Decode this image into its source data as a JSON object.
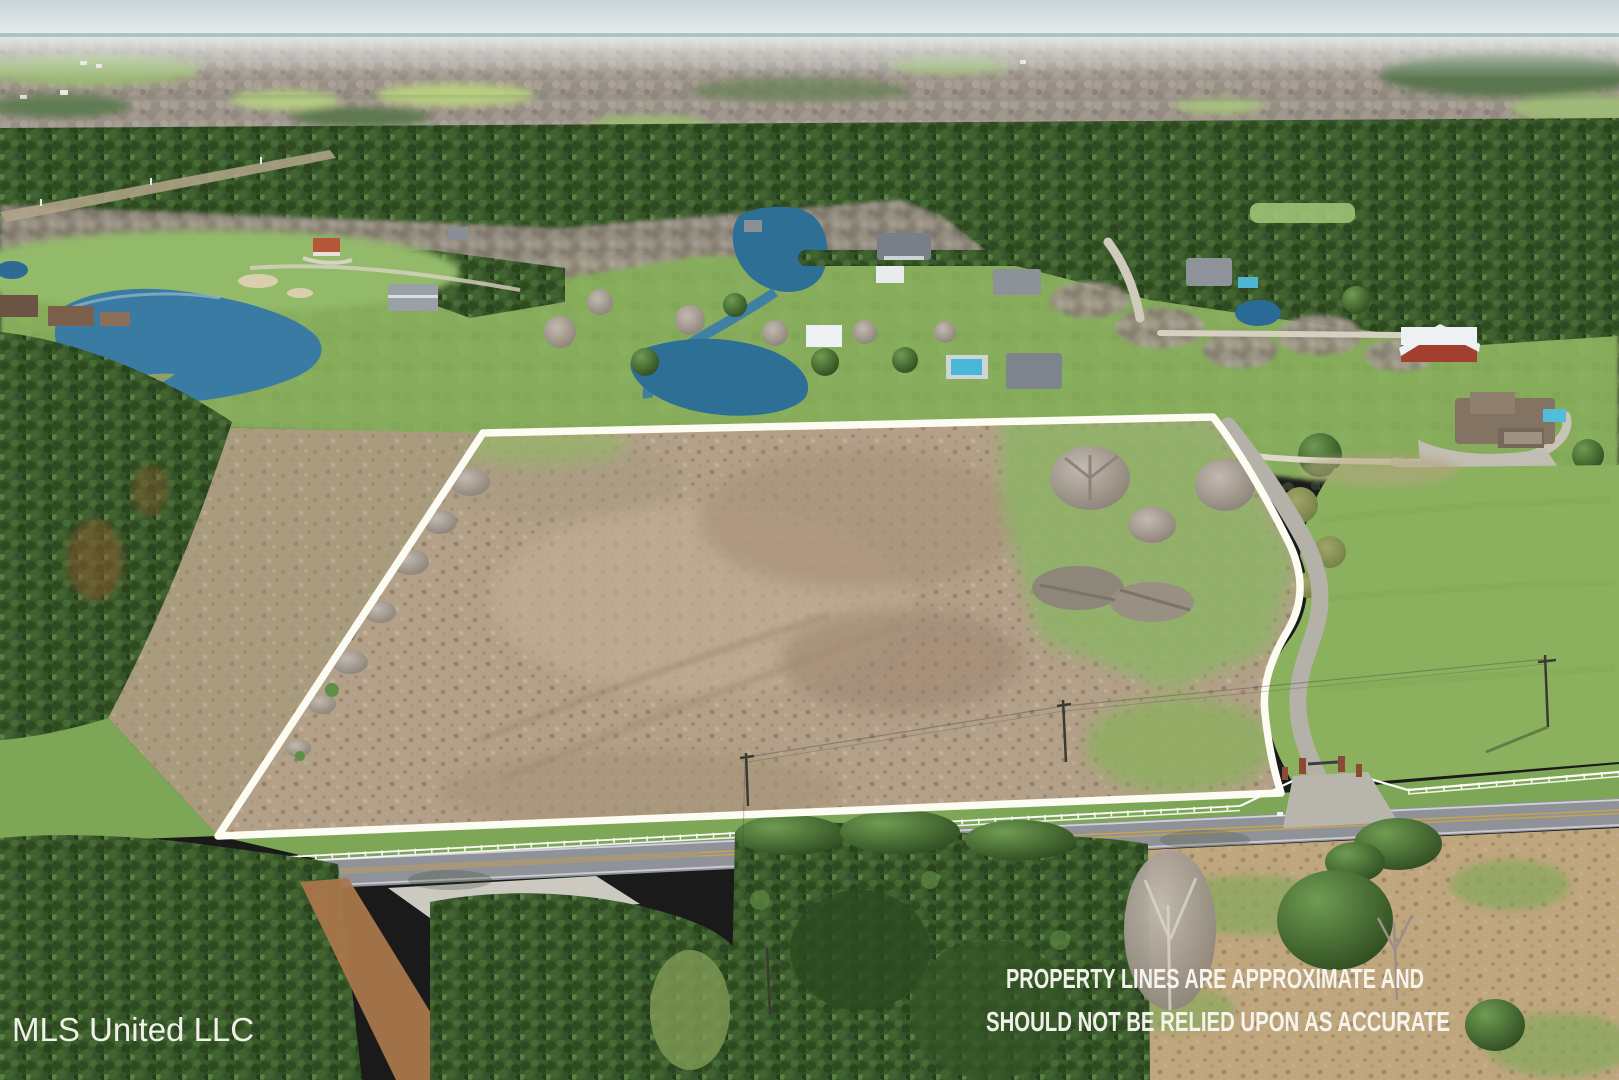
{
  "watermark": {
    "text": "MLS United LLC"
  },
  "disclaimer": {
    "line1": "PROPERTY LINES ARE APPROXIMATE AND",
    "line2": "SHOULD NOT BE RELIED UPON AS ACCURATE"
  },
  "palette": {
    "sky": "#cdd9dc",
    "haze": "#e6edec",
    "horizon_blue": "#7fa0a4",
    "distant_base": "#a49c94",
    "pine_forest": "#3a5a2b",
    "bare_forest": "#9a9087",
    "lawn_green": "#86ac5c",
    "golf_green": "#93ba69",
    "parcel_tan": "#b3a089",
    "left_field_tan": "#a99c7e",
    "pond_blue": "#3a7ba3",
    "pond_deep": "#2e6f95",
    "road_gray": "#8f9399",
    "driveway_gray": "#b4b1a8",
    "concrete": "#ccc9c1",
    "dirt_orange": "#a9764a",
    "bottom_field_tan": "#bfa67d",
    "fence_white": "#fdfdfb",
    "boundary_white": "#fdfcf3",
    "center_line_yellow": "#c9a44b",
    "brick_pillar": "#8a4a35",
    "text_white": "#f7f6f0"
  },
  "scene": {
    "features": [
      "aerial-drone-photo",
      "property-boundary-overlay",
      "vacant-tan-parcel",
      "two-lane-road",
      "white-rail-fence",
      "gated-entrance",
      "curving-driveway",
      "ponds",
      "pine-forest",
      "rural-houses",
      "utility-poles"
    ]
  }
}
